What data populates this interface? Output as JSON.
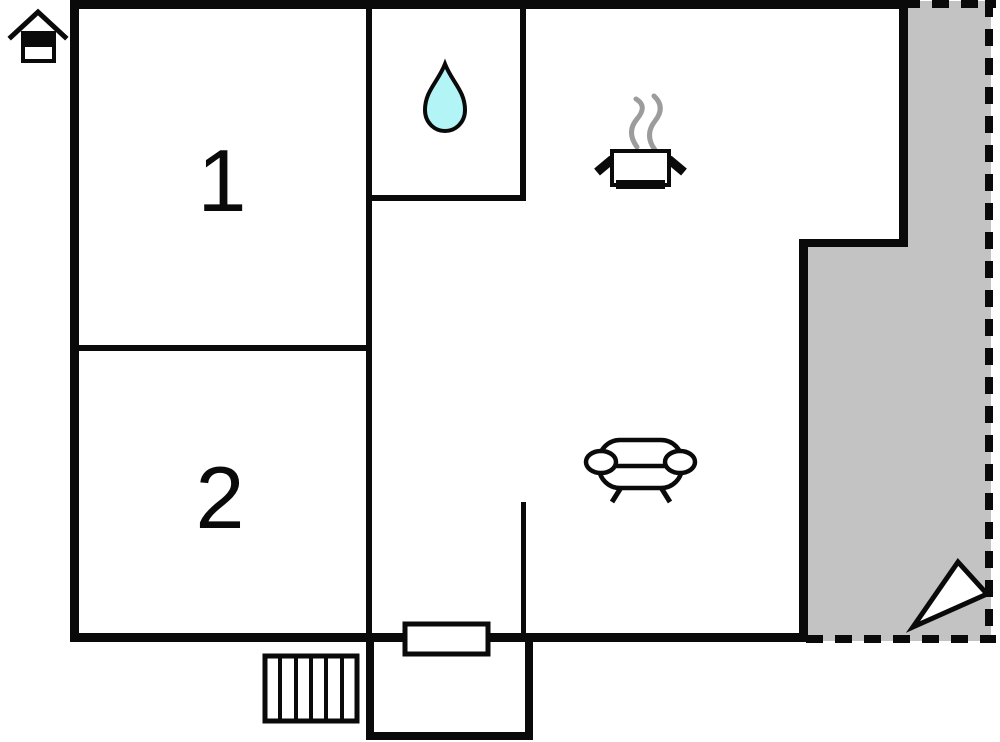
{
  "plan": {
    "title": "holiday-home-floor-plan",
    "rooms": [
      {
        "label": "1"
      },
      {
        "label": "2"
      }
    ],
    "icons": {
      "house": "house-icon",
      "water_drop": "water-drop-icon",
      "cooking_pot": "cooking-pot-icon",
      "steam": "steam-lines",
      "sofa": "sofa-icon",
      "stairs": "stairs-icon",
      "door": "door-symbol",
      "north_arrow": "north-arrow-icon"
    },
    "colors": {
      "wall": "#0a0a0a",
      "terrace_fill": "#c3c3c3",
      "water_drop_fill": "#b3f4f6",
      "steam": "#9c9c9c",
      "icon_fill": "#ffffff",
      "background": "#ffffff"
    }
  }
}
